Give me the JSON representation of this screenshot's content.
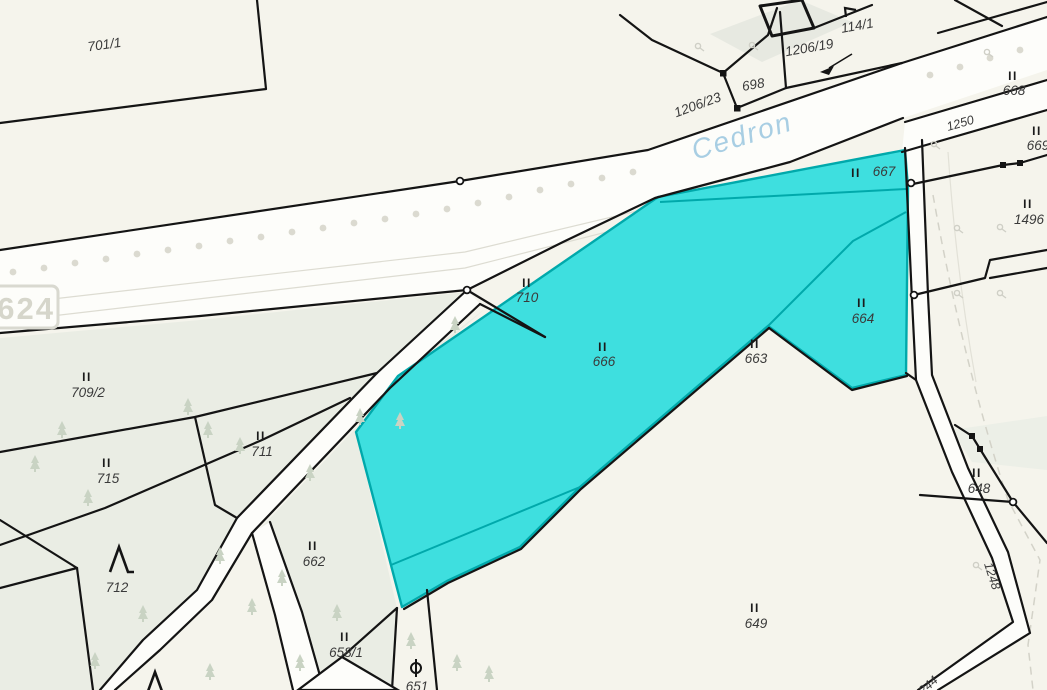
{
  "map": {
    "title": "cadastral-map-view",
    "stream_label": "Cedron",
    "road_number_box": "8624",
    "colors": {
      "background": "#f5f4ec",
      "road_white": "#fdfdfa",
      "tint_green": "#eaede4",
      "boundary_black": "#141414",
      "selection_fill": "#3edfdf",
      "selection_border": "#00a9ab",
      "stream_text": "#a8cee3",
      "faint_gray": "#d9d8d0"
    },
    "selected_parcel_ids": [
      "666",
      "663",
      "664",
      "667"
    ],
    "road_labels": [
      {
        "text": "1250"
      },
      {
        "text": "1248"
      },
      {
        "text": "1244"
      }
    ],
    "parcels": [
      {
        "label": "701/1",
        "marker": ""
      },
      {
        "label": "1206/23",
        "marker": ""
      },
      {
        "label": "698",
        "marker": ""
      },
      {
        "label": "1206/19",
        "marker": ""
      },
      {
        "label": "114/1",
        "marker": ""
      },
      {
        "label": "668",
        "marker": "II"
      },
      {
        "label": "669",
        "marker": "II"
      },
      {
        "label": "667",
        "marker": "II"
      },
      {
        "label": "1496",
        "marker": "II"
      },
      {
        "label": "710",
        "marker": "II"
      },
      {
        "label": "709/2",
        "marker": "II"
      },
      {
        "label": "666",
        "marker": "II"
      },
      {
        "label": "663",
        "marker": "II"
      },
      {
        "label": "664",
        "marker": "II"
      },
      {
        "label": "715",
        "marker": "II"
      },
      {
        "label": "711",
        "marker": "II"
      },
      {
        "label": "712",
        "marker": ""
      },
      {
        "label": "662",
        "marker": "II"
      },
      {
        "label": "658/1",
        "marker": "II"
      },
      {
        "label": "651",
        "marker": ""
      },
      {
        "label": "648",
        "marker": "II"
      },
      {
        "label": "649",
        "marker": "II"
      }
    ]
  }
}
